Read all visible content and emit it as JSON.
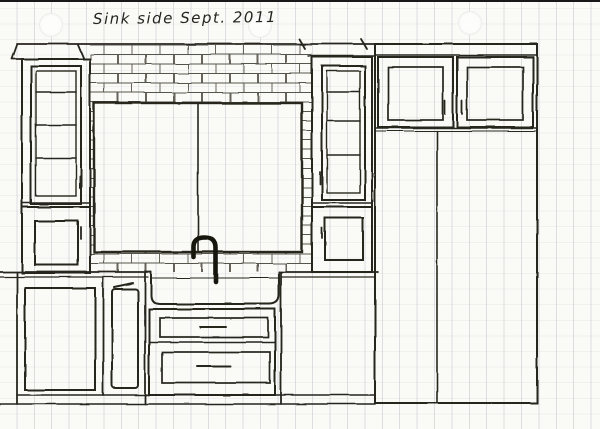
{
  "title": "Sink side Sept. 2011",
  "sketch": {
    "kind": "hand-drawn kitchen cabinet elevation",
    "colors": {
      "ink": "#26251f",
      "paper": "#fafaf7",
      "rule_line": "#c9ced6",
      "tile_line": "#57544b"
    },
    "components": [
      "crown-moulding",
      "left-glass-door-cabinet",
      "left-upper-door-cabinet",
      "subway-tile-backsplash",
      "window-two-panes",
      "gooseneck-faucet",
      "farmhouse-apron-sink",
      "sink-drawer-stack",
      "left-base-door-cabinet",
      "narrow-pullout-cabinet",
      "right-glass-door-cabinet",
      "right-upper-door-cabinet",
      "upper-cabinets-over-pantry",
      "tall-pantry-cabinet",
      "countertop",
      "toe-kick-floor-line"
    ]
  }
}
